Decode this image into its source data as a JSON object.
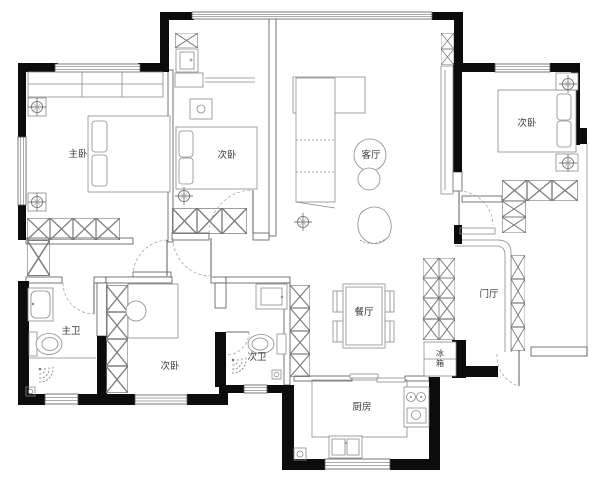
{
  "drawing": {
    "type": "apartment-floor-plan",
    "rooms": {
      "master_bedroom": {
        "label": "主卧"
      },
      "bedroom_top_middle": {
        "label": "次卧"
      },
      "bedroom_top_right": {
        "label": "次卧"
      },
      "bedroom_bottom": {
        "label": "次卧"
      },
      "living_room": {
        "label": "客厅"
      },
      "dining_room": {
        "label": "餐厅"
      },
      "foyer": {
        "label": "门厅"
      },
      "kitchen": {
        "label": "厨房"
      },
      "master_bathroom": {
        "label": "主卫"
      },
      "secondary_bathroom": {
        "label": "次卫"
      }
    },
    "appliances": {
      "fridge_char_top": "冰",
      "fridge_char_bottom": "箱"
    },
    "colors": {
      "wall": "#0c0c0c",
      "line": "#565656",
      "background": "#ffffff"
    }
  }
}
